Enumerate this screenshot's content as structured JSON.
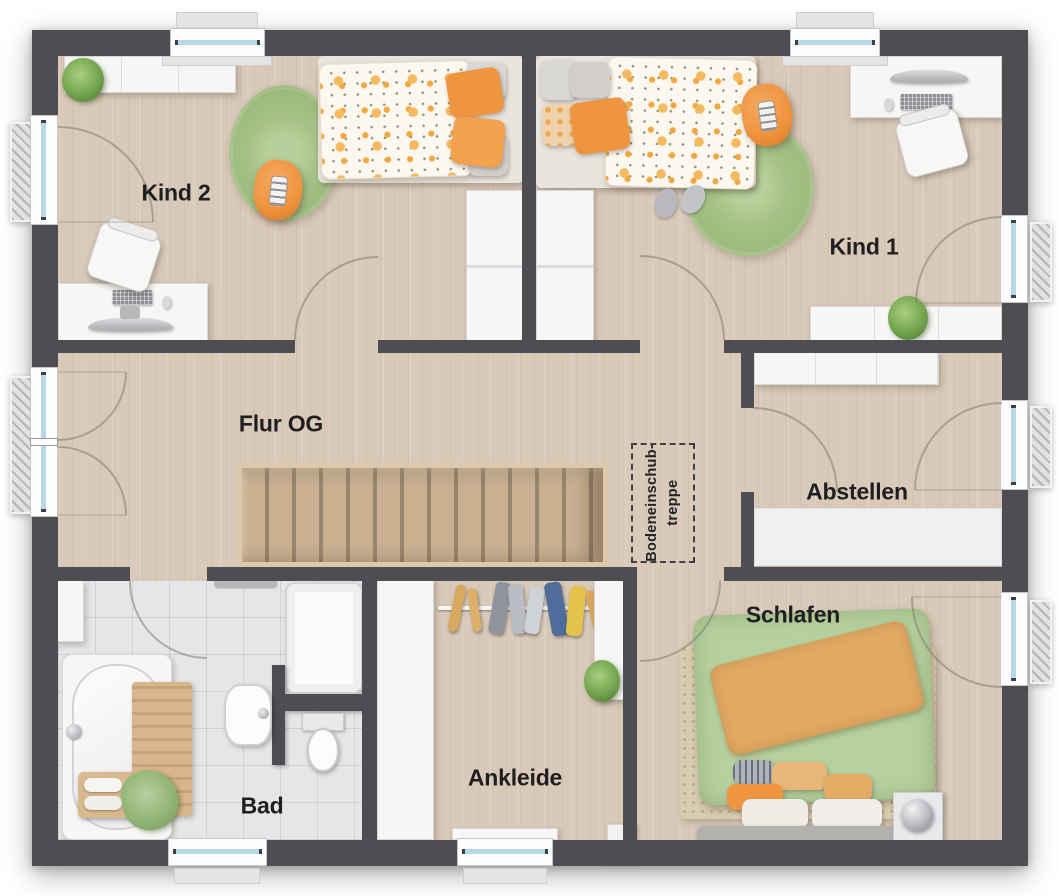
{
  "colors": {
    "wall": "#4d4d52",
    "floor_wood": "#d9c9b8",
    "floor_tile": "#e5e6e8",
    "furniture_white": "#f6f6f5",
    "window_glass": "#b5d7e8",
    "rug_green": "#a6c287",
    "accent_orange": "#ef9540",
    "bed_green": "#b6d09f",
    "blanket_tan": "#e2aa65",
    "rug_beige": "#d8cbae",
    "stair_wood": "#c8b091",
    "label_text": "#1f1f22"
  },
  "rooms": {
    "kind2": {
      "label": "Kind 2"
    },
    "kind1": {
      "label": "Kind 1"
    },
    "flur": {
      "label": "Flur OG"
    },
    "abstellen": {
      "label": "Abstellen"
    },
    "schlafen": {
      "label": "Schlafen"
    },
    "ankleide": {
      "label": "Ankleide"
    },
    "bad": {
      "label": "Bad"
    }
  },
  "attic_hatch": {
    "line1": "Bodeneinschub-",
    "line2": "treppe"
  }
}
